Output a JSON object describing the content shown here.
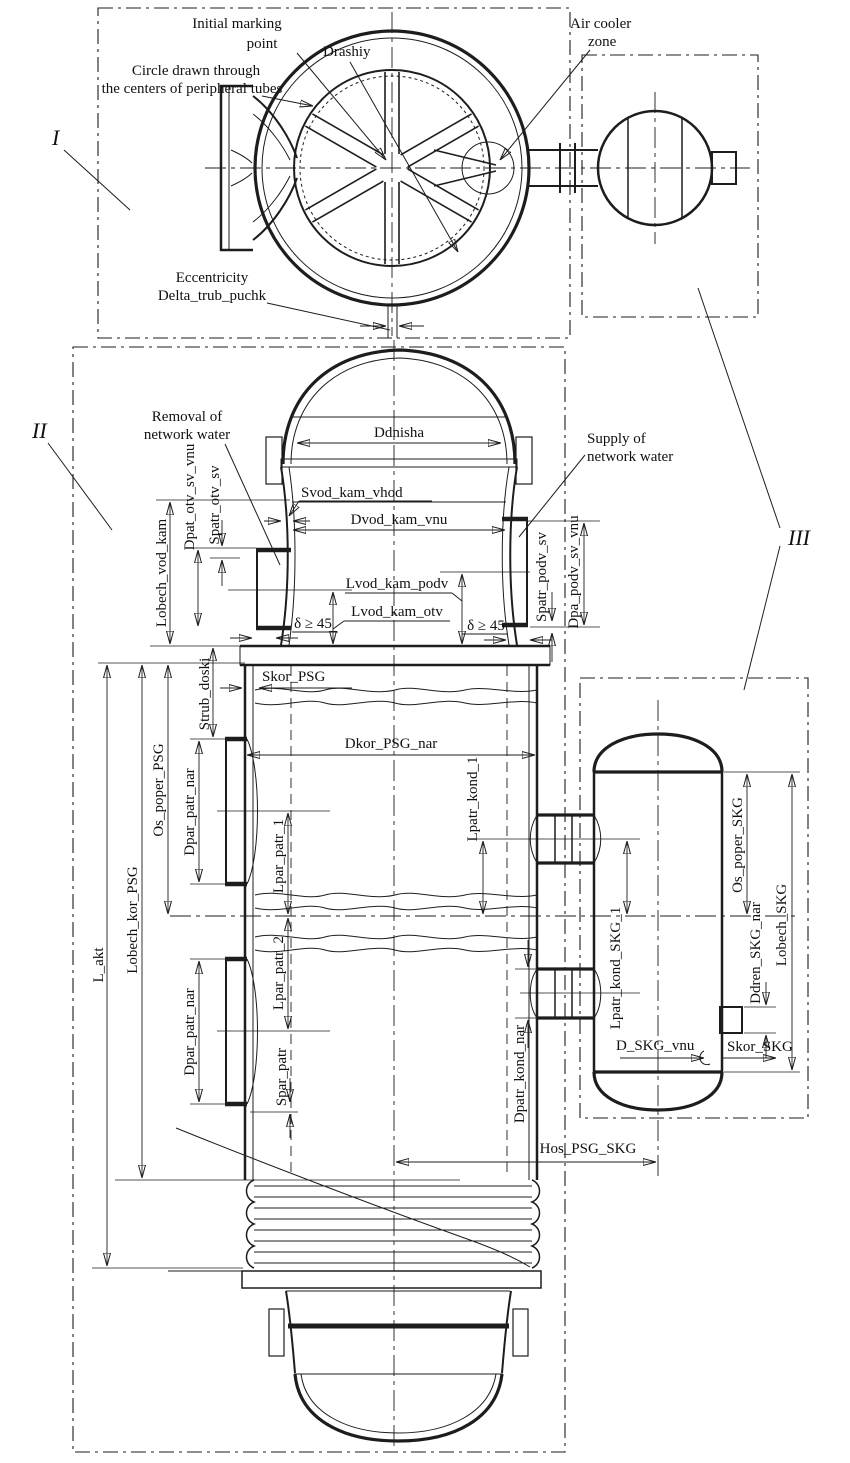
{
  "colors": {
    "line": "#1d1d1d",
    "background": "#ffffff",
    "pad_fill": "#d8d8d8"
  },
  "regions": {
    "i": "I",
    "ii": "II",
    "iii": "III"
  },
  "notes": {
    "initial_marking_1": "Initial marking",
    "initial_marking_2": "point",
    "drashiy": "Drashiy",
    "periph_circle_1": "Circle drawn through",
    "periph_circle_2": "the centers of peripheral tubes",
    "air_cooler_1": "Air cooler",
    "air_cooler_2": "zone",
    "eccentricity_1": "Eccentricity",
    "eccentricity_2": "Delta_trub_puchk",
    "removal_1": "Removal of",
    "removal_2": "network water",
    "supply_1": "Supply of",
    "supply_2": "network water",
    "weld_left": "δ ≥ 45",
    "weld_right": "δ ≥ 45"
  },
  "dims": {
    "ddnisha": "Ddnisha",
    "svod_kam_vhod": "Svod_kam_vhod",
    "dvod_kam_vnu": "Dvod_kam_vnu",
    "lvod_kam_podv": "Lvod_kam_podv",
    "lvod_kam_otv": "Lvod_kam_otv",
    "dpat_otv_sv_vnu": "Dpat_otv_sv_vnu",
    "spatr_otv_sv": "Spatr_otv_sv",
    "lobech_vod_kam": "Lobech_vod_kam",
    "spatr_podv_sv": "Spatr_podv_sv",
    "dpa_podv_sv_vnu": "Dpa_podv_sv_vnu",
    "skor_psg": "Skor_PSG",
    "strub_doski": "Strub_doski",
    "dkor_psg_nar": "Dkor_PSG_nar",
    "os_poper_psg": "Os_poper_PSG",
    "dpar_patr_nar_upper": "Dpar_patr_nar",
    "dpar_patr_nar_lower": "Dpar_patr_nar",
    "lpar_patr_1": "Lpar_patr_1",
    "lpar_patr_2": "Lpar_patr_2",
    "spar_patr": "Spar_patr",
    "l_akt": "L_akt",
    "lobech_kor_psg": "Lobech_kor_PSG",
    "lpatr_kond_1": "Lpatr_kond_1",
    "dpatr_kond_nar": "Dpatr_kond_nar",
    "hos_psg_skg": "Hos_PSG_SKG",
    "os_poper_skg": "Os_poper_SKG",
    "lobech_skg": "Lobech_SKG",
    "ddren_skg_nar": "Ddren_SKG_nar",
    "lpatr_kond_skg_1": "Lpatr_kond_SKG_1",
    "d_skg_vnu": "D_SKG_vnu",
    "skor_skg": "Skor_SKG"
  }
}
